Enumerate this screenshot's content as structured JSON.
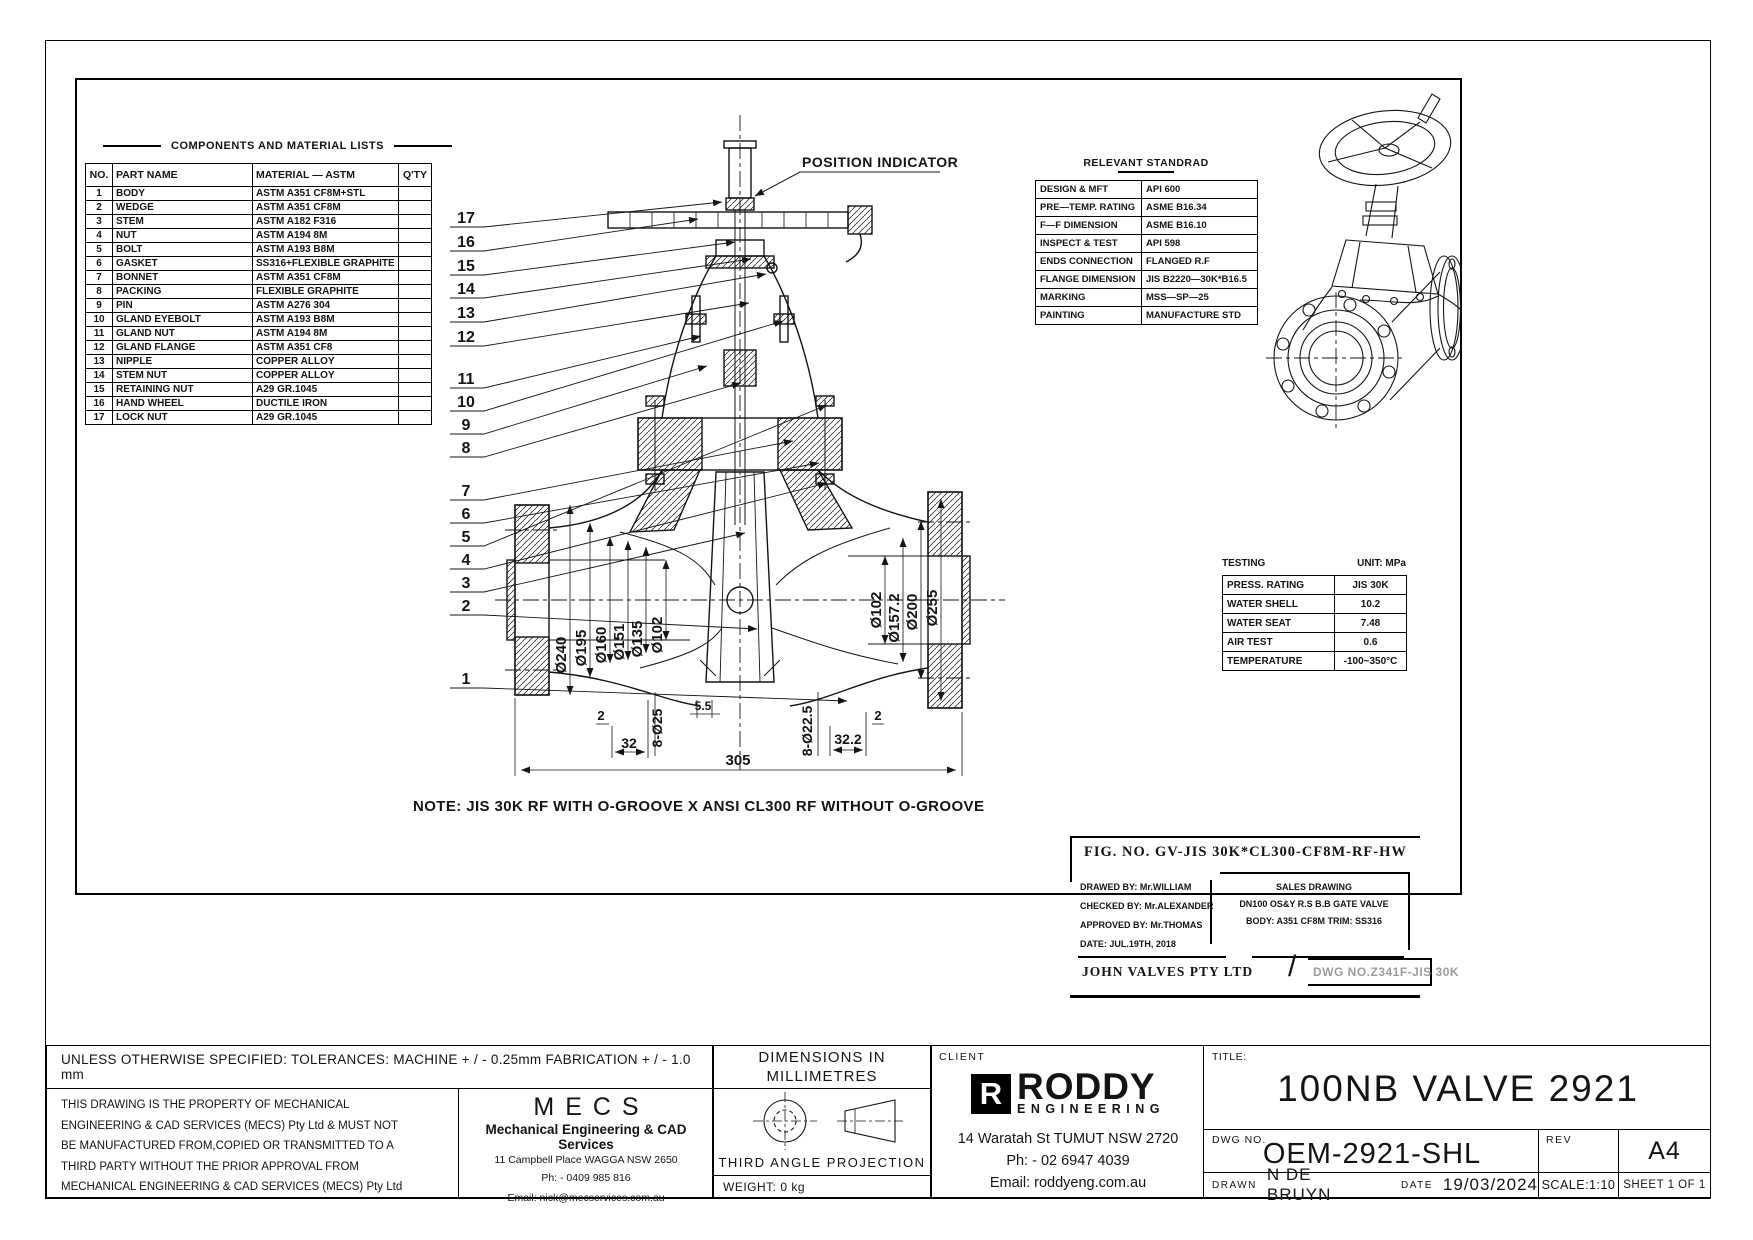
{
  "components_table": {
    "title": "COMPONENTS AND MATERIAL LISTS",
    "headers": [
      "NO.",
      "PART NAME",
      "MATERIAL — ASTM",
      "Q'TY"
    ],
    "rows": [
      [
        "1",
        "BODY",
        "ASTM A351 CF8M+STL",
        ""
      ],
      [
        "2",
        "WEDGE",
        "ASTM A351 CF8M",
        ""
      ],
      [
        "3",
        "STEM",
        "ASTM A182 F316",
        ""
      ],
      [
        "4",
        "NUT",
        "ASTM A194 8M",
        ""
      ],
      [
        "5",
        "BOLT",
        "ASTM A193 B8M",
        ""
      ],
      [
        "6",
        "GASKET",
        "SS316+FLEXIBLE GRAPHITE",
        ""
      ],
      [
        "7",
        "BONNET",
        "ASTM A351 CF8M",
        ""
      ],
      [
        "8",
        "PACKING",
        "FLEXIBLE GRAPHITE",
        ""
      ],
      [
        "9",
        "PIN",
        "ASTM A276 304",
        ""
      ],
      [
        "10",
        "GLAND EYEBOLT",
        "ASTM A193 B8M",
        ""
      ],
      [
        "11",
        "GLAND NUT",
        "ASTM A194 8M",
        ""
      ],
      [
        "12",
        "GLAND FLANGE",
        "ASTM A351 CF8",
        ""
      ],
      [
        "13",
        "NIPPLE",
        "COPPER ALLOY",
        ""
      ],
      [
        "14",
        "STEM NUT",
        "COPPER ALLOY",
        ""
      ],
      [
        "15",
        "RETAINING NUT",
        "A29 GR.1045",
        ""
      ],
      [
        "16",
        "HAND WHEEL",
        "DUCTILE IRON",
        ""
      ],
      [
        "17",
        "LOCK NUT",
        "A29 GR.1045",
        ""
      ]
    ]
  },
  "standards_table": {
    "title": "RELEVANT STANDRAD",
    "rows": [
      [
        "DESIGN & MFT",
        "API 600"
      ],
      [
        "PRE—TEMP. RATING",
        "ASME B16.34"
      ],
      [
        "F—F DIMENSION",
        "ASME B16.10"
      ],
      [
        "INSPECT & TEST",
        "API 598"
      ],
      [
        "ENDS CONNECTION",
        "FLANGED R.F"
      ],
      [
        "FLANGE DIMENSION",
        "JIS B2220—30K*B16.5"
      ],
      [
        "MARKING",
        "MSS—SP—25"
      ],
      [
        "PAINTING",
        "MANUFACTURE STD"
      ]
    ]
  },
  "testing_table": {
    "title": "TESTING",
    "unit": "UNIT: MPa",
    "rows": [
      [
        "PRESS. RATING",
        "JIS 30K"
      ],
      [
        "WATER SHELL",
        "10.2"
      ],
      [
        "WATER SEAT",
        "7.48"
      ],
      [
        "AIR TEST",
        "0.6"
      ],
      [
        "TEMPERATURE",
        "-100~350°C"
      ]
    ]
  },
  "fig_block": {
    "fig_no": "FIG. NO. GV-JIS 30K*CL300-CF8M-RF-HW",
    "drawed": "DRAWED BY: Mr.WILLIAM",
    "checked": "CHECKED BY: Mr.ALEXANDER",
    "approved": "APPROVED BY: Mr.THOMAS",
    "date": "DATE: JUL.19TH, 2018",
    "sales_title": "SALES DRAWING",
    "sales_line1": "DN100 OS&Y R.S B.B GATE VALVE",
    "sales_line2": "BODY: A351 CF8M TRIM: SS316",
    "company": "JOHN VALVES PTY LTD",
    "slash": "/",
    "dwg_no": "DWG NO.Z341F-JIS 30K"
  },
  "drawing": {
    "note": "NOTE: JIS 30K RF WITH O-GROOVE X ANSI CL300 RF WITHOUT O-GROOVE",
    "position_indicator": "POSITION INDICATOR",
    "balloons": [
      "17",
      "16",
      "15",
      "14",
      "13",
      "12",
      "11",
      "10",
      "9",
      "8",
      "7",
      "6",
      "5",
      "4",
      "3",
      "2",
      "1"
    ],
    "dims_left": [
      "Ø240",
      "Ø195",
      "Ø160",
      "Ø151",
      "Ø135",
      "Ø102"
    ],
    "dim_face": "5.5",
    "dims_right": [
      "Ø102",
      "Ø157.2",
      "Ø200",
      "Ø255"
    ],
    "dims_bottom": [
      "2",
      "32",
      "8-Ø25",
      "305",
      "8-Ø22.5",
      "32.2",
      "2"
    ]
  },
  "title_block": {
    "tolerances": "UNLESS OTHERWISE SPECIFIED: TOLERANCES: MACHINE + / - 0.25mm  FABRICATION + / - 1.0 mm",
    "dims_note_line1": "DIMENSIONS IN",
    "dims_note_line2": "MILLIMETRES",
    "property_lines": [
      "THIS DRAWING IS THE PROPERTY OF MECHANICAL",
      "ENGINEERING & CAD SERVICES (MECS) Pty Ltd & MUST NOT",
      "BE MANUFACTURED FROM,COPIED OR TRANSMITTED TO A",
      "THIRD PARTY WITHOUT THE PRIOR APPROVAL FROM",
      "MECHANICAL ENGINEERING & CAD SERVICES (MECS) Pty Ltd"
    ],
    "mecs": {
      "logo": "MECS",
      "subtitle": "Mechanical Engineering & CAD Services",
      "address": "11 Campbell Place WAGGA NSW 2650",
      "phone": "Ph: - 0409 985 816",
      "email": "Email: nick@mecservices.com.au"
    },
    "projection_label": "THIRD ANGLE PROJECTION",
    "weight": "WEIGHT: 0 kg",
    "client": {
      "label": "CLIENT",
      "logo_r": "R",
      "logo_name": "RODDY",
      "logo_sub": "ENGINEERING",
      "address": "14 Waratah St TUMUT NSW 2720",
      "phone": "Ph: - 02 6947 4039",
      "email": "Email: roddyeng.com.au"
    },
    "title_label": "TITLE:",
    "title": "100NB VALVE 2921",
    "dwg_label": "DWG NO.",
    "dwg_no": "OEM-2921-SHL",
    "rev_label": "REV",
    "size": "A4",
    "drawn_label": "DRAWN",
    "drawn": "N DE BRUYN",
    "date_label": "DATE",
    "date": "19/03/2024",
    "scale": "SCALE:1:10",
    "sheet": "SHEET 1 OF 1"
  }
}
